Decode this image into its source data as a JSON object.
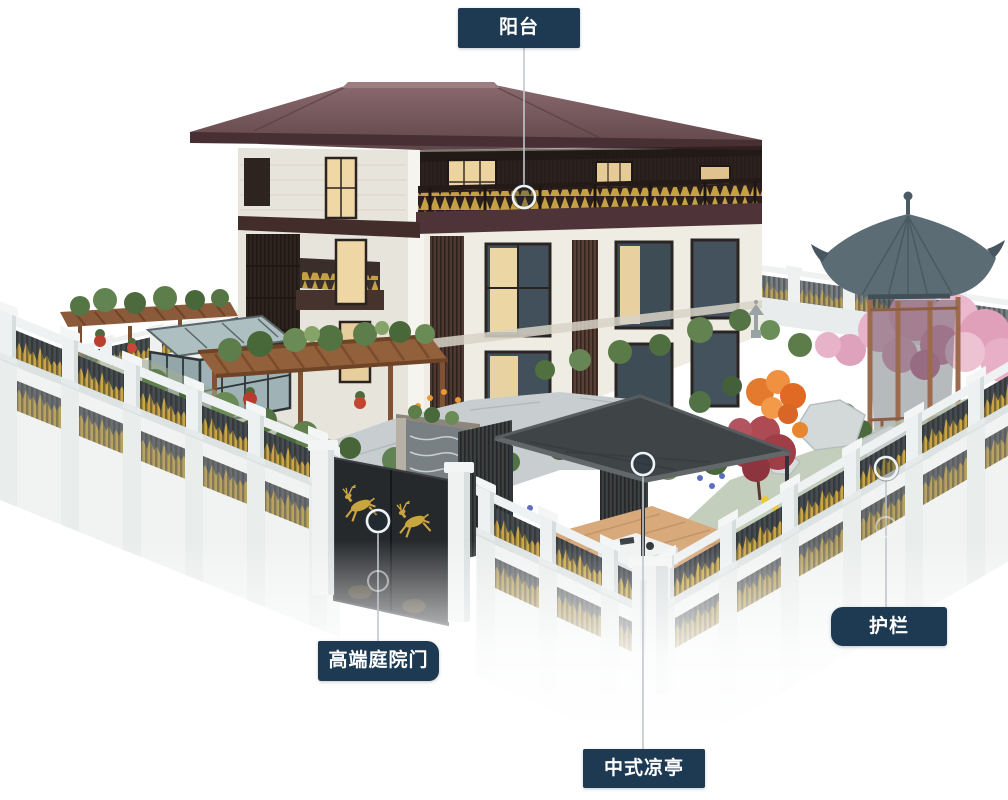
{
  "annotations": {
    "style": {
      "box_color": "#1d3a52",
      "text_color": "#ffffff",
      "line_color": "#c2c7cb",
      "marker_ring_color": "#f0f3f4"
    },
    "items": [
      {
        "id": "balcony",
        "label": "阳台"
      },
      {
        "id": "courtyard-gate",
        "label": "高端庭院门"
      },
      {
        "id": "chinese-pavilion",
        "label": "中式凉亭"
      },
      {
        "id": "guardrail",
        "label": "护栏"
      }
    ]
  },
  "scene": {
    "subject": "chinese-villa-courtyard-render",
    "palette": {
      "roof": "#6f5356",
      "gold_accent": "#c9a545",
      "fence_panel": "#474c50",
      "fence_pillar": "#eff1f1",
      "gazebo_roof": "#5b6c75",
      "blossom": "#e2a5be",
      "maple": "#a03e48",
      "deck_wood": "#d7a97b",
      "pavilion_roof": "#3f4447"
    }
  }
}
